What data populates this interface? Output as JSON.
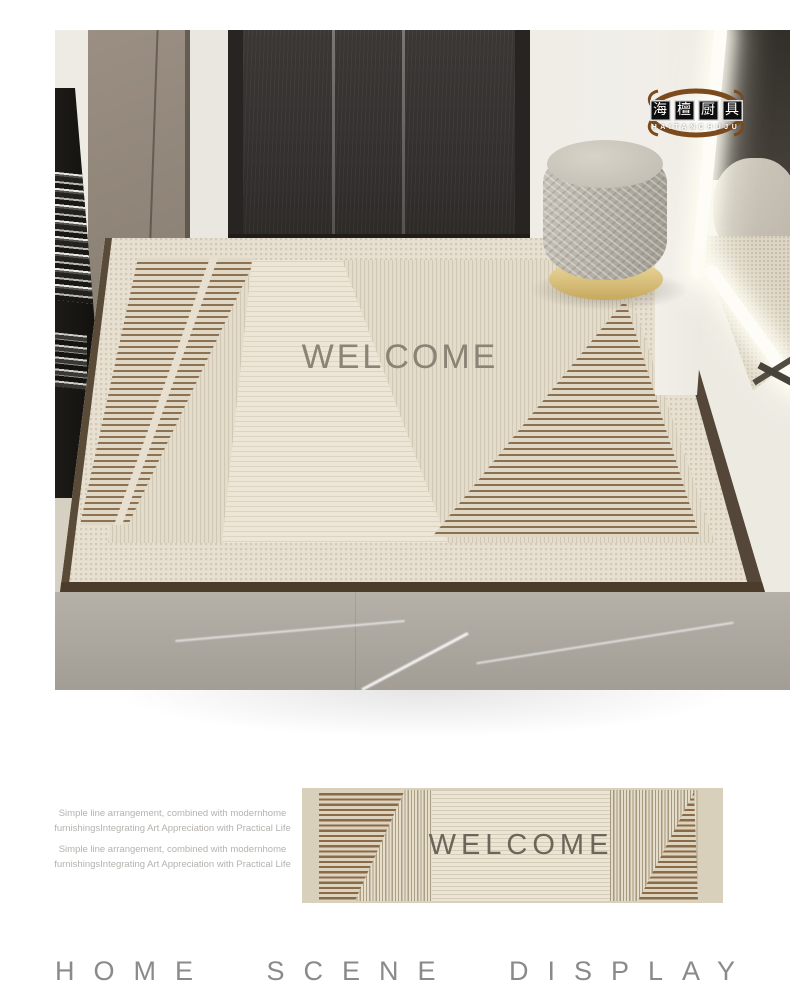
{
  "brand_logo": {
    "seal_characters": [
      "海",
      "檀",
      "厨",
      "具"
    ],
    "latin_name": "HAITANCHUJU"
  },
  "scene": {
    "mat_text": "WELCOME"
  },
  "product_preview": {
    "mat_text": "WELCOME"
  },
  "description": {
    "lines": [
      "Simple line arrangement, combined with modernhome",
      "furnishingsIntegrating Art Appreciation with Practical Life",
      "Simple line arrangement, combined with modernhome",
      "furnishingsIntegrating Art Appreciation with Practical Life"
    ]
  },
  "footer": {
    "title": "HOME SCENE DISPLAY"
  },
  "colors": {
    "stripe_brown": "#8a6a47",
    "mat_cream": "#ece5d4",
    "mat_beige": "#d9d0bc",
    "logo_arc_brown": "#7b4a1d",
    "welcome_text": "#6b655a",
    "footer_text": "#8a8a8a"
  }
}
